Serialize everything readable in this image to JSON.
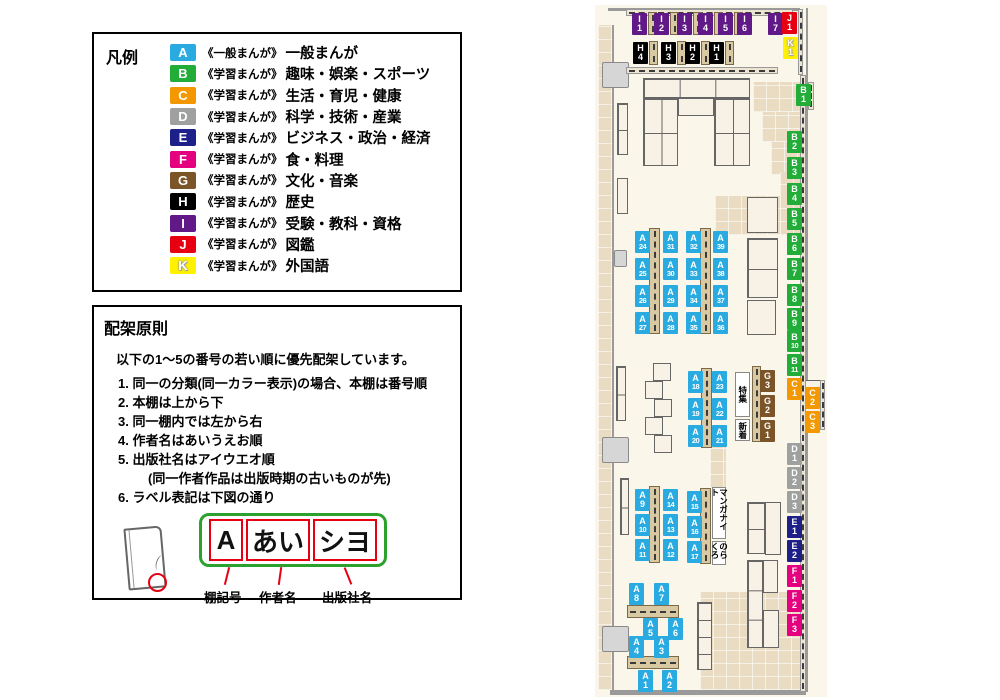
{
  "legend": {
    "title": "凡例",
    "items": [
      {
        "code": "A",
        "color": "#29abe2",
        "category": "《一般まんが》",
        "label": "一般まんが"
      },
      {
        "code": "B",
        "color": "#22ac38",
        "category": "《学習まんが》",
        "label": "趣味・娯楽・スポーツ"
      },
      {
        "code": "C",
        "color": "#f39800",
        "category": "《学習まんが》",
        "label": "生活・育児・健康"
      },
      {
        "code": "D",
        "color": "#9fa0a0",
        "category": "《学習まんが》",
        "label": "科学・技術・産業"
      },
      {
        "code": "E",
        "color": "#1d2088",
        "category": "《学習まんが》",
        "label": "ビジネス・政治・経済"
      },
      {
        "code": "F",
        "color": "#e4007f",
        "category": "《学習まんが》",
        "label": "食・料理"
      },
      {
        "code": "G",
        "color": "#7b5428",
        "category": "《学習まんが》",
        "label": "文化・音楽"
      },
      {
        "code": "H",
        "color": "#000000",
        "category": "《学習まんが》",
        "label": "歴史"
      },
      {
        "code": "I",
        "color": "#601986",
        "category": "《学習まんが》",
        "label": "受験・教科・資格"
      },
      {
        "code": "J",
        "color": "#e60012",
        "category": "《学習まんが》",
        "label": "図鑑"
      },
      {
        "code": "K",
        "color": "#fff100",
        "category": "《学習まんが》",
        "label": "外国語"
      }
    ]
  },
  "rules": {
    "title": "配架原則",
    "intro": "以下の1〜5の番号の若い順に優先配架しています。",
    "items": [
      {
        "num": "1.",
        "text": "同一の分類(同一カラー表示)の場合、本棚は番号順"
      },
      {
        "num": "2.",
        "text": "本棚は上から下"
      },
      {
        "num": "3.",
        "text": "同一棚内では左から右"
      },
      {
        "num": "4.",
        "text": "作者名はあいうえお順"
      },
      {
        "num": "5.",
        "text": "出版社名はアイウエオ順",
        "note": "(同一作者作品は出版時期の古いものが先)"
      },
      {
        "num": "6.",
        "text": "ラベル表記は下図の通り"
      }
    ],
    "example": {
      "shelf_code": "A",
      "author": "あい",
      "publisher": "シヨ",
      "captions": [
        "棚記号",
        "作者名",
        "出版社名"
      ]
    }
  },
  "map": {
    "colors": {
      "A": "#29abe2",
      "B": "#22ac38",
      "C": "#f39800",
      "D": "#9fa0a0",
      "E": "#1d2088",
      "F": "#e4007f",
      "G": "#7b5428",
      "H": "#000000",
      "I": "#601986",
      "J": "#e60012",
      "K": "#fff100"
    },
    "labels": [
      [
        "I1",
        37,
        8
      ],
      [
        "I2",
        59,
        8
      ],
      [
        "I3",
        82,
        8
      ],
      [
        "I4",
        103,
        8
      ],
      [
        "I5",
        123,
        8
      ],
      [
        "I6",
        142,
        8
      ],
      [
        "I7",
        173,
        8
      ],
      [
        "J1",
        187,
        7
      ],
      [
        "K1",
        188,
        32
      ],
      [
        "H4",
        38,
        37
      ],
      [
        "H3",
        66,
        37
      ],
      [
        "H2",
        90,
        37
      ],
      [
        "H1",
        114,
        37
      ],
      [
        "B1",
        201,
        79
      ],
      [
        "B2",
        192,
        126
      ],
      [
        "B3",
        192,
        152
      ],
      [
        "B4",
        192,
        178
      ],
      [
        "B5",
        192,
        203
      ],
      [
        "B6",
        192,
        228
      ],
      [
        "B7",
        192,
        253
      ],
      [
        "B8",
        192,
        279
      ],
      [
        "B9",
        192,
        303
      ],
      [
        "B10",
        192,
        325
      ],
      [
        "B11",
        192,
        349
      ],
      [
        "C1",
        192,
        373
      ],
      [
        "C2",
        210,
        382
      ],
      [
        "C3",
        210,
        406
      ],
      [
        "D1",
        192,
        438
      ],
      [
        "D2",
        192,
        462
      ],
      [
        "D3",
        192,
        486
      ],
      [
        "E1",
        192,
        511
      ],
      [
        "E2",
        192,
        535
      ],
      [
        "F1",
        192,
        560
      ],
      [
        "F2",
        192,
        585
      ],
      [
        "F3",
        192,
        609
      ],
      [
        "A24",
        40,
        226
      ],
      [
        "A25",
        40,
        253
      ],
      [
        "A26",
        40,
        280
      ],
      [
        "A27",
        40,
        307
      ],
      [
        "A31",
        68,
        226
      ],
      [
        "A30",
        68,
        253
      ],
      [
        "A29",
        68,
        280
      ],
      [
        "A28",
        68,
        307
      ],
      [
        "A32",
        91,
        226
      ],
      [
        "A33",
        91,
        253
      ],
      [
        "A34",
        91,
        280
      ],
      [
        "A35",
        91,
        307
      ],
      [
        "A39",
        118,
        226
      ],
      [
        "A38",
        118,
        253
      ],
      [
        "A37",
        118,
        280
      ],
      [
        "A36",
        118,
        307
      ],
      [
        "A18",
        93,
        366
      ],
      [
        "A19",
        93,
        393
      ],
      [
        "A20",
        93,
        420
      ],
      [
        "A23",
        117,
        366
      ],
      [
        "A22",
        117,
        393
      ],
      [
        "A21",
        117,
        420
      ],
      [
        "G3",
        165,
        365
      ],
      [
        "G2",
        165,
        390
      ],
      [
        "G1",
        165,
        415
      ],
      [
        "A9",
        40,
        484
      ],
      [
        "A10",
        40,
        509
      ],
      [
        "A11",
        40,
        534
      ],
      [
        "A14",
        68,
        484
      ],
      [
        "A13",
        68,
        509
      ],
      [
        "A12",
        68,
        534
      ],
      [
        "A15",
        92,
        486
      ],
      [
        "A16",
        92,
        511
      ],
      [
        "A17",
        92,
        536
      ],
      [
        "A8",
        34,
        578
      ],
      [
        "A7",
        59,
        578
      ],
      [
        "A5",
        48,
        613
      ],
      [
        "A6",
        73,
        613
      ],
      [
        "A4",
        34,
        631
      ],
      [
        "A3",
        59,
        631
      ],
      [
        "A1",
        43,
        665
      ],
      [
        "A2",
        67,
        665
      ]
    ],
    "signs": [
      [
        "特集",
        140,
        367,
        15,
        45
      ],
      [
        "新着",
        140,
        414,
        15,
        22
      ],
      [
        "マンガナイト",
        117,
        482,
        14,
        52
      ],
      [
        "のらくろ",
        117,
        536,
        14,
        24
      ]
    ],
    "paths": [
      [
        3,
        20,
        15,
        665
      ],
      [
        158,
        77,
        47,
        30
      ],
      [
        167,
        107,
        38,
        30
      ],
      [
        176,
        137,
        29,
        33
      ],
      [
        185,
        167,
        20,
        26
      ],
      [
        120,
        191,
        85,
        39
      ],
      [
        115,
        425,
        16,
        58
      ],
      [
        105,
        587,
        100,
        98
      ]
    ],
    "walls": [
      [
        13,
        3,
        192,
        3
      ],
      [
        17,
        20,
        2,
        667
      ],
      [
        15,
        685,
        196,
        5
      ],
      [
        211,
        3,
        2,
        684
      ]
    ],
    "doors": [
      [
        7,
        57,
        27,
        26
      ],
      [
        19,
        245,
        13,
        17
      ],
      [
        7,
        432,
        27,
        26
      ],
      [
        7,
        621,
        27,
        26
      ]
    ],
    "furniture": [
      [
        48,
        73,
        107,
        20,
        3,
        1
      ],
      [
        48,
        93,
        35,
        68,
        2,
        2
      ],
      [
        119,
        93,
        36,
        68,
        2,
        2
      ],
      [
        83,
        93,
        36,
        18,
        1,
        1
      ],
      [
        152,
        192,
        31,
        36,
        1,
        1
      ],
      [
        152,
        233,
        31,
        60,
        1,
        2
      ],
      [
        152,
        295,
        29,
        35,
        1,
        1
      ],
      [
        58,
        358,
        18,
        18,
        1,
        1
      ],
      [
        50,
        376,
        18,
        18,
        1,
        1
      ],
      [
        59,
        394,
        18,
        18,
        1,
        1
      ],
      [
        50,
        412,
        18,
        18,
        1,
        1
      ],
      [
        59,
        430,
        18,
        18,
        1,
        1
      ],
      [
        102,
        597,
        15,
        68,
        1,
        4
      ],
      [
        152,
        497,
        18,
        52,
        1,
        2
      ],
      [
        170,
        497,
        16,
        53,
        1,
        1
      ],
      [
        152,
        555,
        16,
        88,
        1,
        3
      ],
      [
        168,
        555,
        15,
        33,
        1,
        1
      ],
      [
        168,
        605,
        16,
        38,
        1,
        1
      ],
      [
        22,
        98,
        11,
        52,
        1,
        2
      ],
      [
        22,
        173,
        11,
        36,
        1,
        1
      ],
      [
        21,
        361,
        10,
        55,
        1,
        2
      ],
      [
        25,
        473,
        9,
        57,
        1,
        2
      ],
      [
        205,
        375,
        22,
        50,
        1,
        1
      ]
    ],
    "shelves": [
      [
        54,
        223,
        11,
        106
      ],
      [
        105,
        223,
        11,
        106
      ],
      [
        106,
        363,
        11,
        80
      ],
      [
        157,
        361,
        9,
        76
      ],
      [
        54,
        481,
        11,
        77
      ],
      [
        105,
        483,
        11,
        76
      ],
      [
        32,
        600,
        52,
        13
      ],
      [
        32,
        651,
        52,
        13
      ],
      [
        53,
        7,
        9,
        23
      ],
      [
        75,
        7,
        9,
        23
      ],
      [
        98,
        7,
        9,
        23
      ],
      [
        119,
        7,
        9,
        23
      ],
      [
        139,
        7,
        9,
        23
      ],
      [
        54,
        36,
        9,
        24
      ],
      [
        82,
        36,
        9,
        24
      ],
      [
        106,
        36,
        9,
        24
      ],
      [
        130,
        36,
        9,
        24
      ]
    ],
    "wall_shelves": [
      [
        31,
        4,
        167,
        7
      ],
      [
        31,
        62,
        152,
        7
      ],
      [
        203,
        4,
        5,
        66
      ],
      [
        205,
        70,
        6,
        617
      ],
      [
        213,
        77,
        6,
        28
      ],
      [
        225,
        375,
        5,
        50
      ]
    ]
  }
}
